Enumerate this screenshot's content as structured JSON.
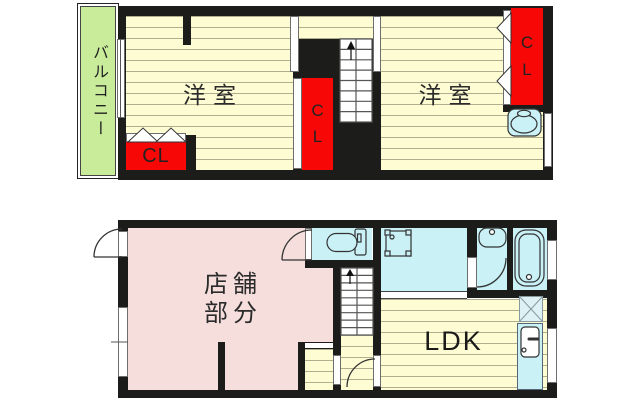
{
  "colors": {
    "wall": "#1c1c1a",
    "wood_floor": "#fdfcd2",
    "floor_stripe": "#b0ae8e",
    "balcony_green": "#c9ec9b",
    "closet_red": "#f80707",
    "shop_pink": "#f5dedb",
    "wet_area_cyan": "#c9f1f6"
  },
  "floor2": {
    "balcony_label": "バルコニー",
    "left_room_label": "洋室",
    "right_room_label": "洋室",
    "closet_left_label": "CL",
    "closet_middle_label": "CL",
    "closet_right_label": "CL"
  },
  "floor1": {
    "shop_line1": "店舗",
    "shop_line2": "部分",
    "ldk_label": "LDK"
  }
}
